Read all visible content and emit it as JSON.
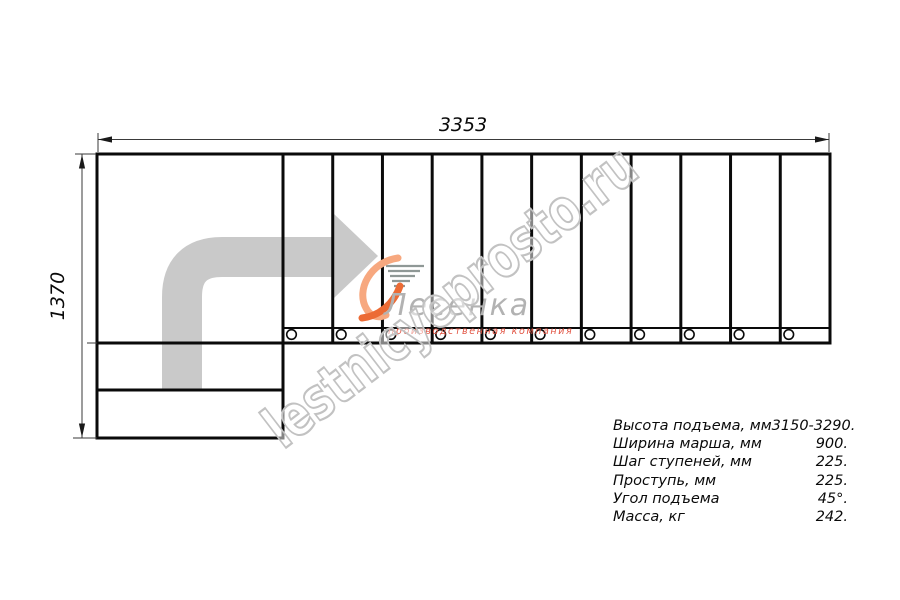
{
  "drawing": {
    "top_dimension": "3353",
    "left_dimension": "1370",
    "tread_count": 11,
    "baluster_count": 11
  },
  "logo": {
    "name": "Лесенка",
    "caption": "производственная компания"
  },
  "watermark": {
    "text": "lestnicyeprosto.ru"
  },
  "specs": {
    "rows": [
      {
        "label": "Высота подъема, мм",
        "value": "3150-3290."
      },
      {
        "label": "Ширина марша, мм",
        "value": "900."
      },
      {
        "label": "Шаг ступеней, мм",
        "value": "225."
      },
      {
        "label": "Проступь, мм",
        "value": "225."
      },
      {
        "label": "Угол подъема",
        "value": "45°."
      },
      {
        "label": "Масса, кг",
        "value": "242."
      }
    ]
  },
  "colors": {
    "line": "#0a0a0a",
    "arrow_gray": "#c9c9c9",
    "watermark_gray": "#c2c2c2",
    "logo_text_gray": "#b2b2b2",
    "logo_caption_red": "#e25544",
    "logo_orange_light": "#f7a87f",
    "logo_orange_dark": "#ec6b35"
  }
}
